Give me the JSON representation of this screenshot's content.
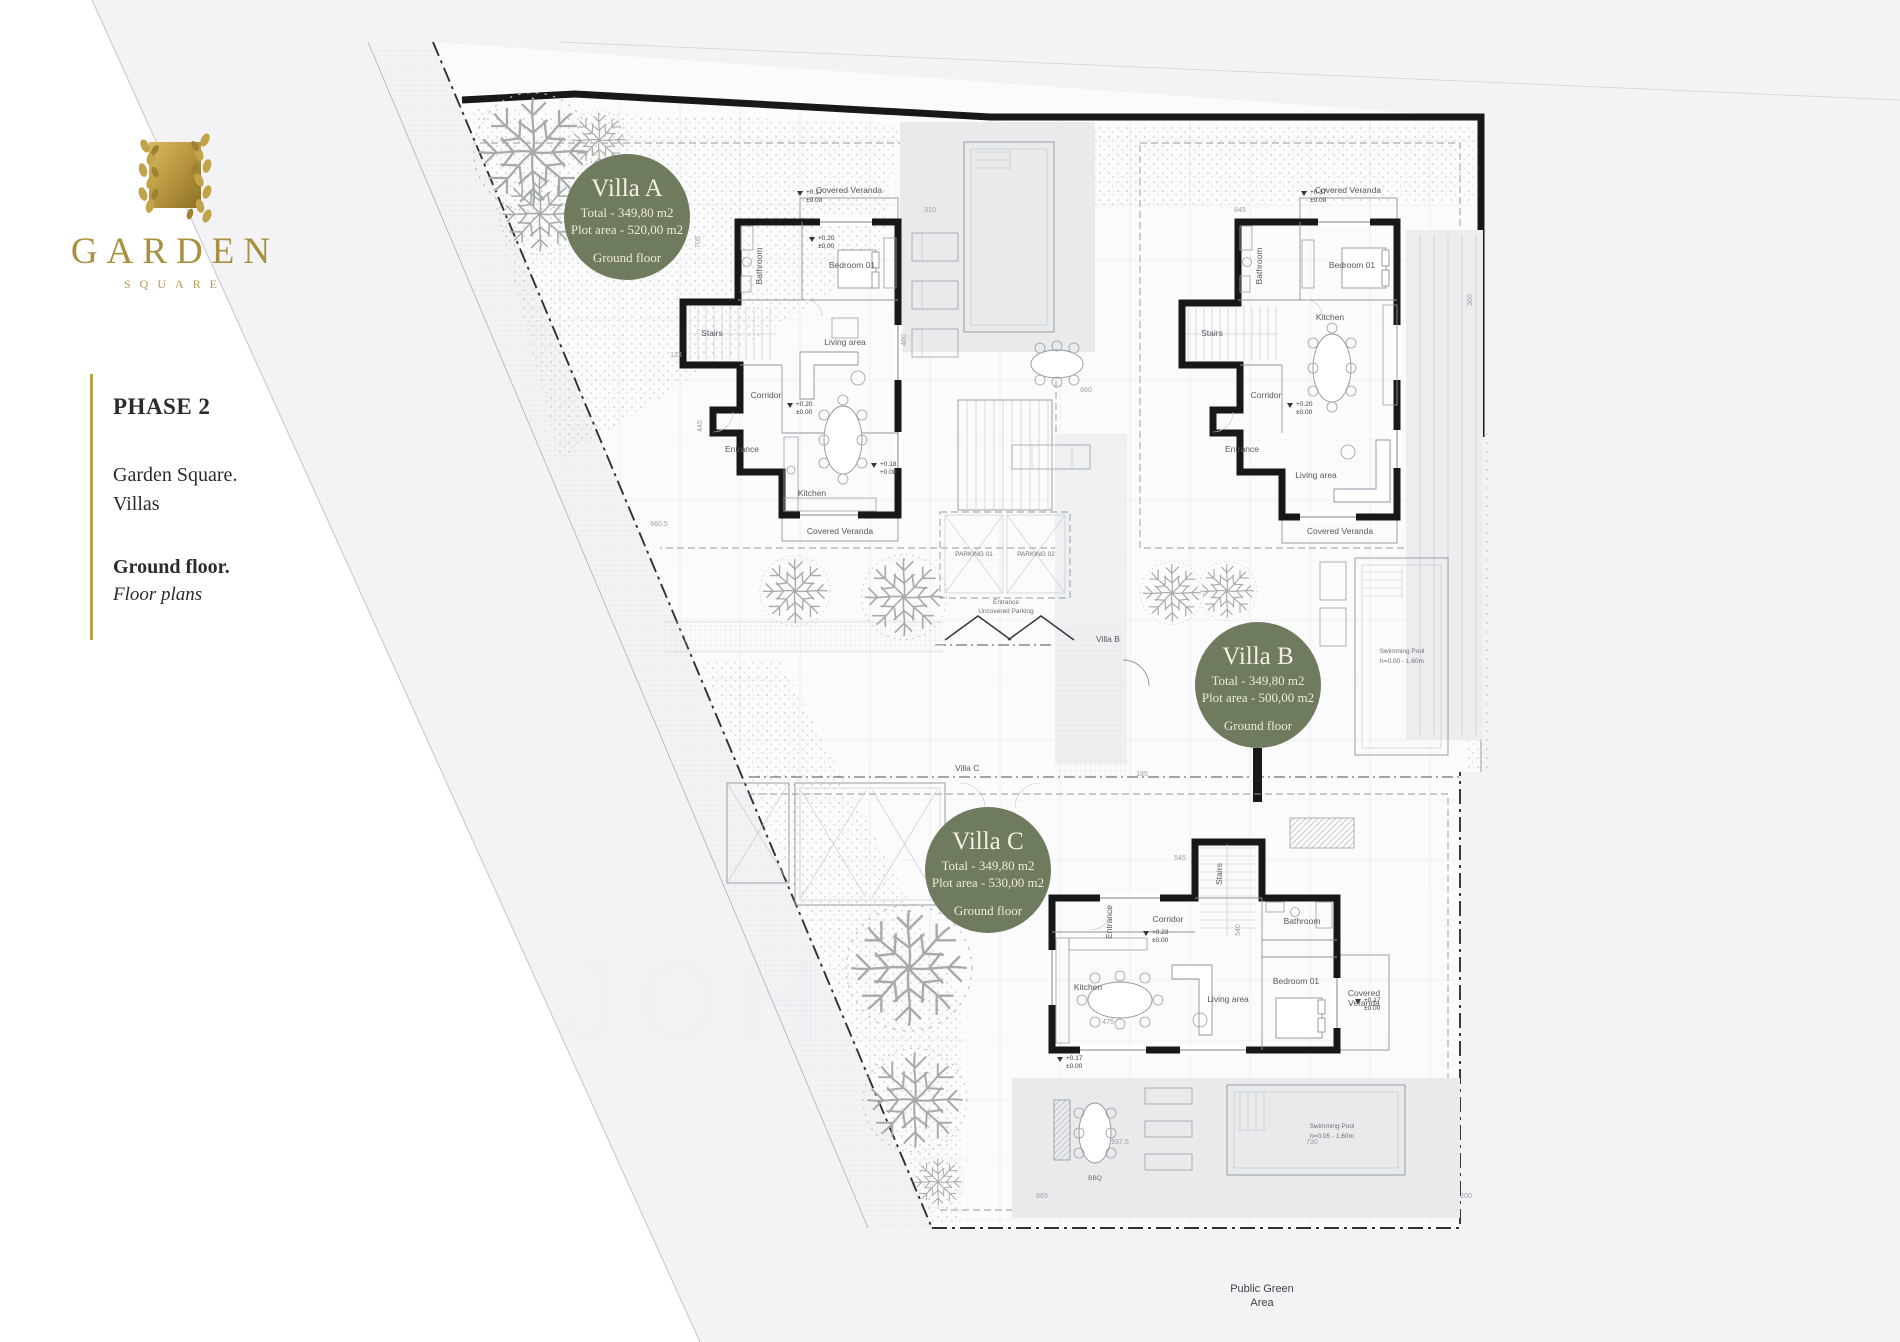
{
  "colors": {
    "badge": "#6f7b5e",
    "badge_text": "#f0ebdc",
    "gold": "#a8913e",
    "plan_bg": "#f3f3f5",
    "plot_bg": "#fbfbfc",
    "wall": "#17181a",
    "deck": "#e9eaec",
    "accent_rule": "#b7a24b"
  },
  "logo": {
    "title": "GARDEN",
    "subtitle": "SQUARE"
  },
  "sidebar": {
    "phase": "PHASE 2",
    "line1": "Garden Square.",
    "line2": "Villas",
    "line3": "Ground floor.",
    "line4": "Floor plans"
  },
  "badges": [
    {
      "name": "Villa A",
      "total": "Total - 349,80 m2",
      "plot": "Plot area - 520,00 m2",
      "floor": "Ground floor"
    },
    {
      "name": "Villa B",
      "total": "Total - 349,80 m2",
      "plot": "Plot area - 500,00 m2",
      "floor": "Ground floor"
    },
    {
      "name": "Villa C",
      "total": "Total - 349,80 m2",
      "plot": "Plot area - 530,00 m2",
      "floor": "Ground floor"
    }
  ],
  "rooms": {
    "a": {
      "veranda_top": "Covered Veranda",
      "bathroom": "Bathroom",
      "bedroom": "Bedroom 01",
      "stairs": "Stairs",
      "corridor": "Corridor",
      "living": "Living area",
      "entrance": "Entrance",
      "kitchen": "Kitchen",
      "veranda_bottom": "Covered Veranda"
    },
    "b": {
      "veranda_top": "Covered Veranda",
      "bathroom": "Bathroom",
      "bedroom": "Bedroom 01",
      "stairs": "Stairs",
      "corridor": "Corridor",
      "kitchen": "Kitchen",
      "entrance": "Entrance",
      "living": "Living area",
      "veranda_bottom": "Covered Veranda"
    },
    "c": {
      "stairs": "Stairs",
      "corridor": "Corridor",
      "bathroom": "Bathroom",
      "entrance": "Entrance",
      "kitchen": "Kitchen",
      "living": "Living area",
      "bedroom": "Bedroom 01",
      "veranda_1": "Covered",
      "veranda_2": "Veranda",
      "bbq": "BBQ"
    }
  },
  "site": {
    "entrance": "Entrance",
    "uncovered": "Uncovered Parking",
    "villa_b": "Villa B",
    "villa_c": "Villa C",
    "parking1": "PARKING 01",
    "parking2": "PARKING 02",
    "green1": "Public Green",
    "green2": "Area",
    "watermark": "JOH"
  },
  "pools": {
    "b1": "Swimming Pool",
    "b2": "h=0.00 - 1.60m",
    "c1": "Swimming Pool",
    "c2": "h=0.05 - 1.60m"
  },
  "levels": [
    [
      "+0.17",
      "±0.00"
    ],
    [
      "+0.20",
      "±0.00"
    ],
    [
      "+0.18",
      "+0.08"
    ],
    [
      "+0.23",
      "±0.00"
    ]
  ],
  "dims": [
    "660.5",
    "310",
    "705",
    "445",
    "460",
    "123",
    "360",
    "845",
    "937.5",
    "730",
    "150",
    "545",
    "475",
    "540",
    "665",
    "200",
    "185",
    "680"
  ]
}
